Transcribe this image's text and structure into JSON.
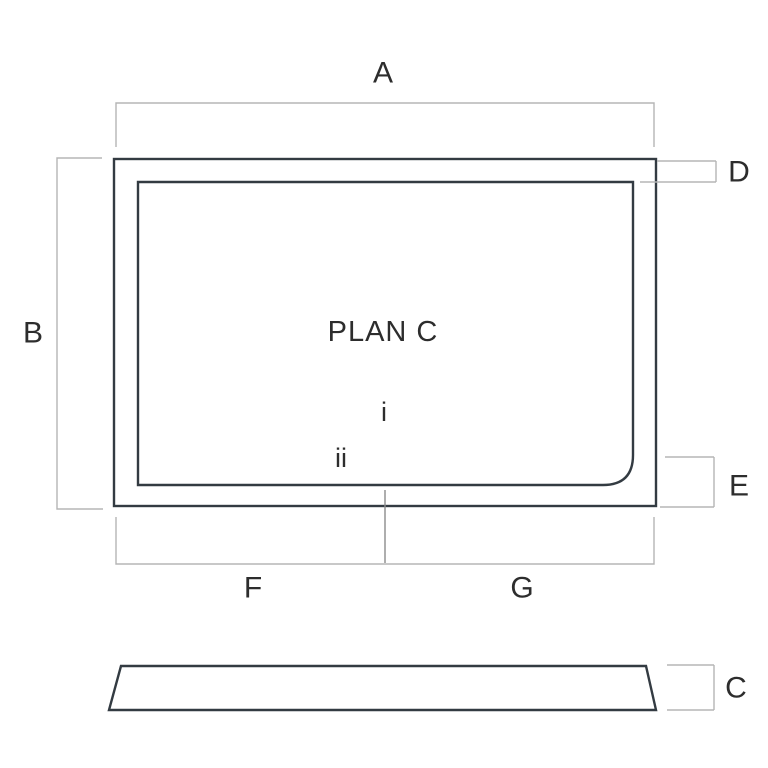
{
  "diagram": {
    "plan_label": "PLAN C",
    "dimension_labels": {
      "a": "A",
      "b": "B",
      "c": "C",
      "d": "D",
      "e": "E",
      "f": "F",
      "g": "G"
    },
    "markers": {
      "i": "i",
      "ii": "ii"
    },
    "colors": {
      "background": "#ffffff",
      "tray_fill": "#9db4c3",
      "tray_outline": "#333b42",
      "dimension_line": "#b5b5b5",
      "leader_line": "#8c8c8c",
      "text": "#2d2d2d",
      "drain_fill": "#ffffff"
    }
  }
}
